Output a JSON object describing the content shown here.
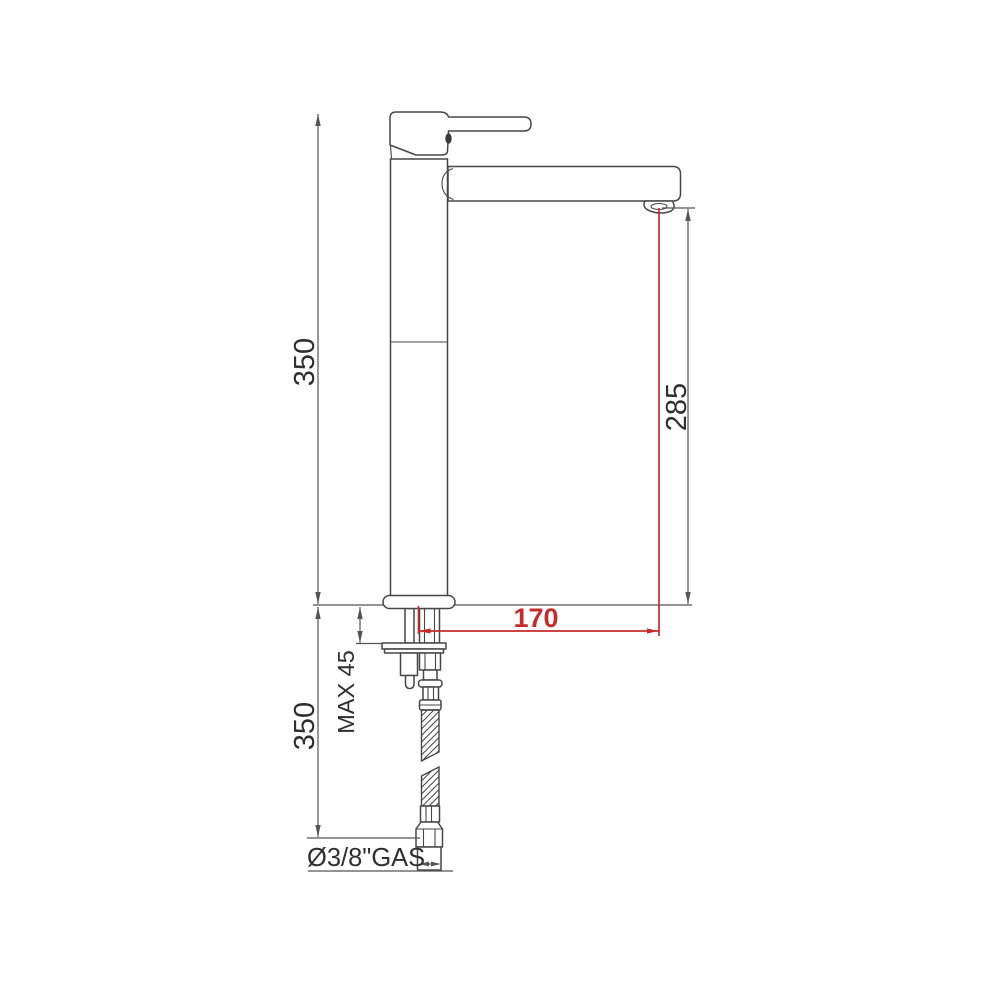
{
  "drawing_labels": {
    "total_height": "350",
    "hose_length": "350",
    "spout_height": "285",
    "spout_reach": "170",
    "max_mounting_thickness": "MAX 45",
    "connector_size": "Ø3/8\"GAS"
  },
  "colors": {
    "background": "#ffffff",
    "line": "#474747",
    "dimension_line": "#555555",
    "text": "#2f2f2f",
    "accent_red": "#c62b2b"
  }
}
